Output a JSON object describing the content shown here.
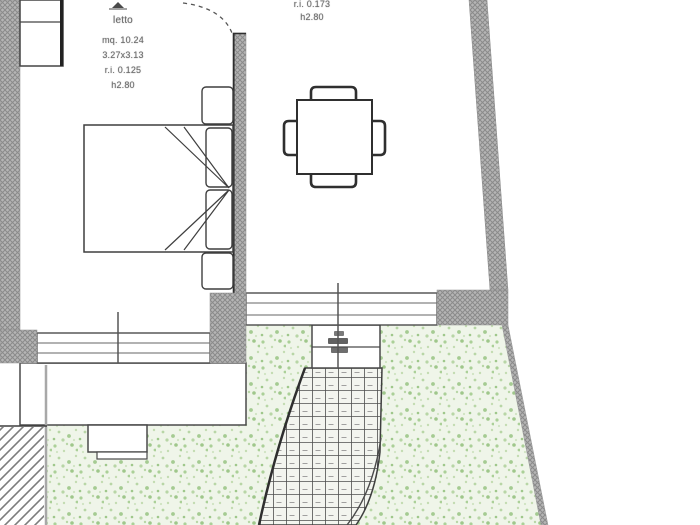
{
  "bedroom": {
    "name": "letto",
    "area": "mq. 10.24",
    "dimensions": "3.27x3.13",
    "light_ratio": "r.i. 0.125",
    "height": "h2.80"
  },
  "dining": {
    "light_ratio": "r.i. 0.173",
    "height": "h2.80"
  },
  "palette": {
    "wall_hatch_gray": "#b5b5b5",
    "wall_hatch_line": "#8a8a8a",
    "drawing_line": "#3f3f3f",
    "garden_base": "#eff5e9",
    "garden_speckle": "#a9cf97",
    "paper": "#ffffff"
  },
  "symbols": {
    "bed": "double-bed-plan-symbol",
    "table": "square-table-with-4-chairs",
    "stairs": "curved-tiled-exterior-steps",
    "door": "door-swing-arc",
    "windows": "double-line-window-band"
  }
}
